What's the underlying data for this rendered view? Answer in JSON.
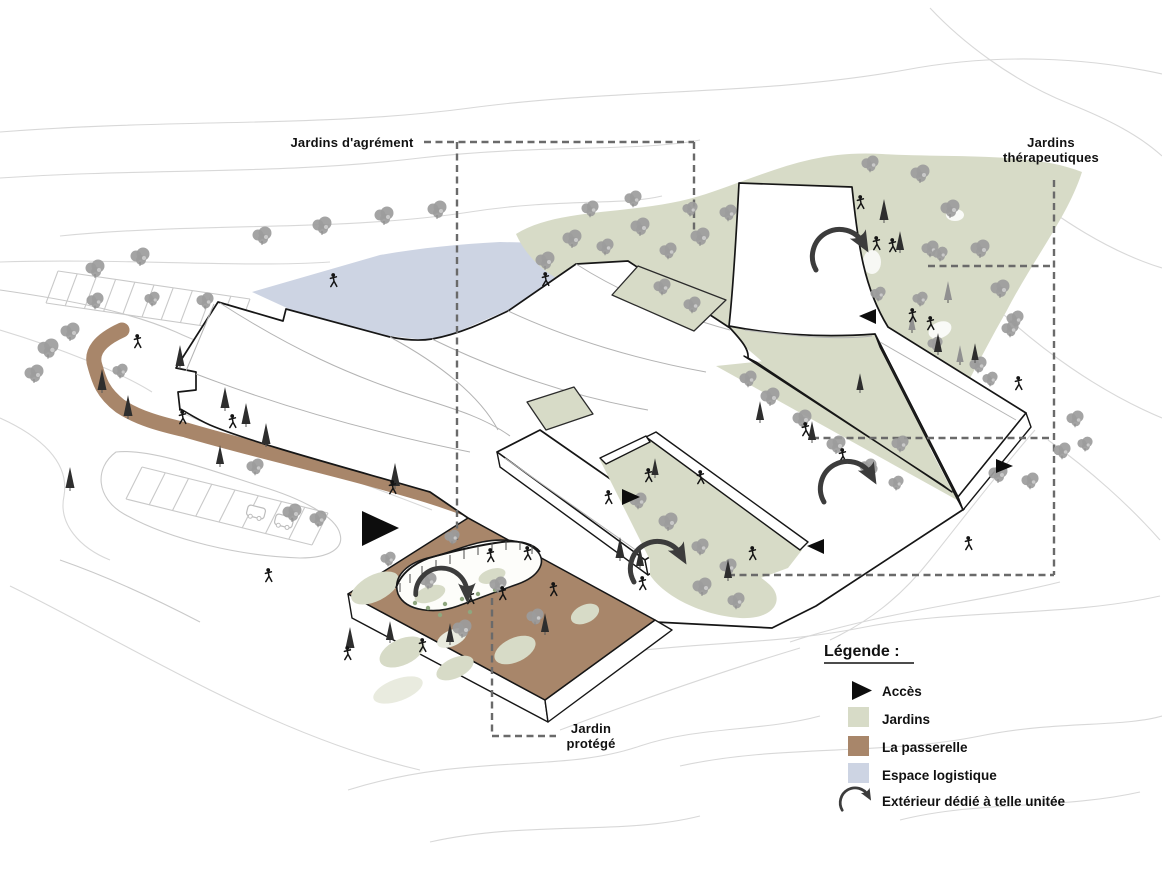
{
  "diagram": {
    "type": "architectural axonometric site plan",
    "labels": {
      "jardins_agrement": "Jardins d'agrément",
      "jardins_therapeutiques_line1": "Jardins",
      "jardins_therapeutiques_line2": "thérapeutiques",
      "jardin_protege_line1": "Jardin",
      "jardin_protege_line2": "protégé"
    }
  },
  "legend": {
    "title": "Légende :",
    "items": [
      {
        "symbol": "access-triangle",
        "label": "Accès"
      },
      {
        "symbol": "color-swatch",
        "color": "#d7dbc7",
        "label": "Jardins"
      },
      {
        "symbol": "color-swatch",
        "color": "#a8866a",
        "label": "La passerelle"
      },
      {
        "symbol": "color-swatch",
        "color": "#cdd4e3",
        "label": "Espace logistique"
      },
      {
        "symbol": "curved-arrow",
        "label": "Extérieur dédié à telle unitée"
      }
    ]
  },
  "colors": {
    "gardens": "#d7dbc7",
    "passerelle": "#a8866a",
    "logistics": "#cdd4e3",
    "outline": "#161616",
    "tree": "#9c9c9c",
    "conifer": "#2e2e2e",
    "arrow": "#3c3c3c",
    "dashed": "#6a6a6a",
    "contour": "#d8d8d8",
    "thin_line": "#b3b3b3",
    "label_text": "#111111"
  }
}
